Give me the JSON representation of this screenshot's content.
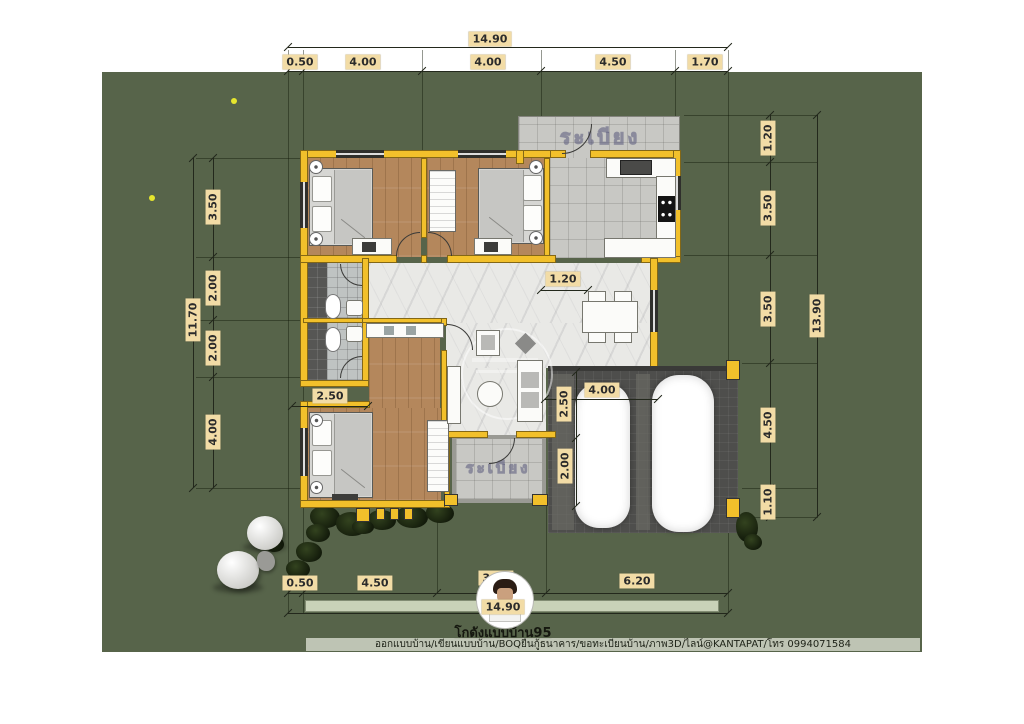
{
  "title": "โกดังแบบบ้าน95",
  "footer": "ออกแบบบ้าน/เขียนแบบบ้าน/BOQยื่นกู้ธนาคาร/ขอทะเบียนบ้าน/ภาพ3D/ไลน์@KANTAPAT/โทร 0994071584",
  "terrace_label": "ระเบียง",
  "dims": {
    "top_total": "14.90",
    "top": [
      "0.50",
      "4.00",
      "4.00",
      "4.50",
      "1.70"
    ],
    "left_total": "11.70",
    "left": [
      "3.50",
      "2.00",
      "2.00",
      "4.00"
    ],
    "right_total": "13.90",
    "right": [
      "1.20",
      "3.50",
      "3.50",
      "4.50",
      "1.10"
    ],
    "bottom_total": "14.90",
    "bottom": [
      "0.50",
      "4.50",
      "3.50",
      "6.20"
    ],
    "interior": {
      "hall_width": "1.20",
      "porch_width": "2.50",
      "carport_bay_depth_1": "2.50",
      "carport_bay_depth_2": "2.00",
      "carport_width": "4.00"
    }
  },
  "colors": {
    "yard": "#57644a",
    "wall": "#f2c02b",
    "label-bg": "#f2dca6",
    "label-text": "#2b2b2b",
    "wood": "#b4875c",
    "marble": "#e9e9e6",
    "tile": "#c8c8c4",
    "carport": "#4e4e4c",
    "dimline": "#23281c"
  }
}
